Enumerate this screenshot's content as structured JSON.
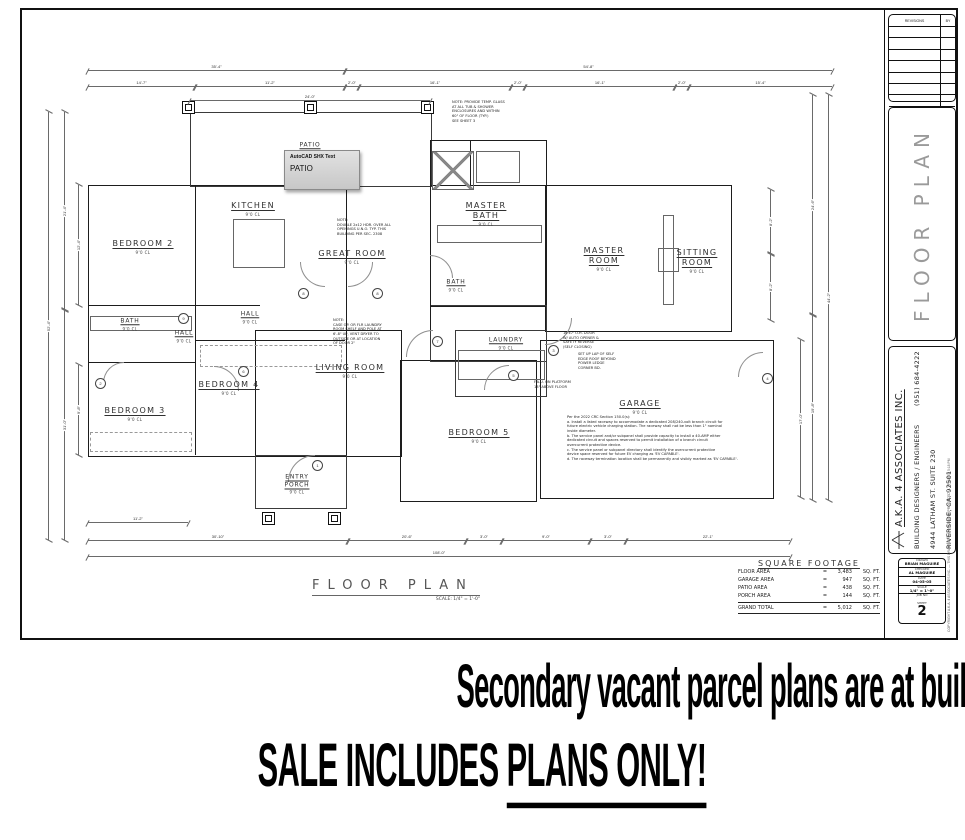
{
  "banner": {
    "line1": "Secondary vacant parcel plans are at building department for approval.",
    "line2_pre": "SALE INCLUDES ",
    "line2_underlined": "PLANS ONLY!"
  },
  "tooltip": {
    "title": "AutoCAD SHX Text",
    "text": "PATIO"
  },
  "plan_title": {
    "label": "FLOOR PLAN",
    "scale": "SCALE: 1/4\" = 1'-0\""
  },
  "rooms": [
    {
      "name": "BEDROOM 2",
      "sub": "9'0 CL",
      "x": 143,
      "y": 247
    },
    {
      "name": "KITCHEN",
      "sub": "9'0 CL",
      "x": 253,
      "y": 209
    },
    {
      "name": "GREAT ROOM",
      "sub": "9'0 CL",
      "x": 352,
      "y": 257
    },
    {
      "name": "MASTER\nBATH",
      "sub": "9'0 CL",
      "x": 486,
      "y": 214
    },
    {
      "name": "MASTER\nROOM",
      "sub": "9'0 CL",
      "x": 604,
      "y": 259
    },
    {
      "name": "SITTING\nROOM",
      "sub": "9'0 CL",
      "x": 697,
      "y": 261
    },
    {
      "name": "BATH",
      "sub": "9'0 CL",
      "x": 130,
      "y": 324,
      "small": true
    },
    {
      "name": "HALL",
      "sub": "9'0 CL",
      "x": 250,
      "y": 317,
      "small": true
    },
    {
      "name": "HALL",
      "sub": "9'0 CL",
      "x": 184,
      "y": 336,
      "small": true
    },
    {
      "name": "BEDROOM 3",
      "sub": "9'0 CL",
      "x": 135,
      "y": 414
    },
    {
      "name": "BEDROOM 4",
      "sub": "9'0 CL",
      "x": 229,
      "y": 388
    },
    {
      "name": "LIVING ROOM",
      "sub": "9'0 CL",
      "x": 350,
      "y": 371
    },
    {
      "name": "LAUNDRY",
      "sub": "9'0 CL",
      "x": 506,
      "y": 343,
      "small": true
    },
    {
      "name": "BEDROOM 5",
      "sub": "9'0 CL",
      "x": 479,
      "y": 436
    },
    {
      "name": "GARAGE",
      "sub": "9'0 CL",
      "x": 640,
      "y": 407
    },
    {
      "name": "ENTRY\nPORCH",
      "sub": "9'0 CL",
      "x": 297,
      "y": 484,
      "small": true
    },
    {
      "name": "PATIO",
      "sub": "",
      "x": 310,
      "y": 145,
      "small": true
    },
    {
      "name": "BATH",
      "sub": "9'0 CL",
      "x": 456,
      "y": 285,
      "small": true
    }
  ],
  "sqft": {
    "title": "SQUARE FOOTAGE",
    "rows": [
      [
        "FLOOR AREA",
        "=",
        "3,483",
        "SQ. FT."
      ],
      [
        "GARAGE AREA",
        "=",
        "947",
        "SQ. FT."
      ],
      [
        "PATIO AREA",
        "=",
        "438",
        "SQ. FT."
      ],
      [
        "PORCH AREA",
        "=",
        "144",
        "SQ. FT."
      ]
    ],
    "total": [
      "GRAND TOTAL",
      "=",
      "5,012",
      "SQ. FT."
    ]
  },
  "titleblock": {
    "revisions_header": "REVISIONS",
    "by_header": "BY",
    "panel_title": "FLOOR PLAN",
    "company": "A.K.A. 4 ASSOCIATES INC.",
    "line2": "BUILDING DESIGNERS / ENGINEERS",
    "line3": "4944 LATHAM ST. SUITE 230",
    "line4": "RIVERSIDE, CA.  92501",
    "phone": "(951) 684-4222",
    "info_rows": [
      [
        "DRAWN",
        "BRIAN MAGUIRE"
      ],
      [
        "CHECKED",
        "AL MAGUIRE"
      ],
      [
        "DATE",
        "04-05-05"
      ],
      [
        "SCALE",
        "1/4\" = 1'-0\""
      ],
      [
        "JOB NO",
        ""
      ]
    ],
    "sheet_label": "SHEET",
    "sheet_number": "2",
    "copyright": "COPYRIGHT A.K.A. 4 ASSOCIATES INC. — THIS DRAWING MAY NOT BE REPRODUCED — PRINTED 5:18 PM"
  },
  "drawing": {
    "walls": [
      [
        88,
        185,
        257,
        270,
        "thick"
      ],
      [
        190,
        112,
        240,
        73,
        "thin"
      ],
      [
        430,
        140,
        115,
        165,
        "thick"
      ],
      [
        545,
        185,
        185,
        145,
        "thick"
      ],
      [
        255,
        330,
        145,
        125,
        "thick"
      ],
      [
        400,
        360,
        135,
        140,
        "thick"
      ],
      [
        540,
        340,
        232,
        157,
        "thick"
      ],
      [
        255,
        455,
        90,
        52,
        "thin"
      ],
      [
        455,
        330,
        90,
        65,
        "thin"
      ],
      [
        430,
        305,
        115,
        55,
        "thin"
      ]
    ],
    "lines": [
      [
        195,
        185,
        120,
        "v"
      ],
      [
        88,
        305,
        172,
        "h"
      ],
      [
        88,
        362,
        107,
        "h"
      ],
      [
        195,
        305,
        150,
        "v"
      ],
      [
        195,
        340,
        150,
        "h"
      ],
      [
        430,
        185,
        115,
        "h"
      ],
      [
        470,
        140,
        45,
        "v"
      ],
      [
        430,
        305,
        25,
        "v"
      ]
    ],
    "fixtures": [
      [
        233,
        219,
        50,
        47,
        "box"
      ],
      [
        476,
        151,
        42,
        30,
        "box"
      ],
      [
        432,
        151,
        40,
        37,
        "xbox"
      ],
      [
        663,
        215,
        9,
        88,
        "box"
      ],
      [
        658,
        248,
        19,
        22,
        "box"
      ],
      [
        458,
        350,
        85,
        28,
        "box"
      ],
      [
        90,
        316,
        100,
        13,
        "box"
      ],
      [
        437,
        225,
        103,
        16,
        "box"
      ],
      [
        200,
        345,
        140,
        20,
        "dash"
      ],
      [
        90,
        432,
        100,
        18,
        "dash"
      ]
    ],
    "posts": [
      [
        182,
        101
      ],
      [
        304,
        101
      ],
      [
        421,
        101
      ],
      [
        262,
        512
      ],
      [
        328,
        512
      ]
    ],
    "arcs": [
      [
        300,
        262,
        24,
        "bl"
      ],
      [
        348,
        262,
        24,
        "br"
      ],
      [
        214,
        366,
        24,
        "tr"
      ],
      [
        288,
        455,
        26,
        "tl"
      ],
      [
        545,
        318,
        26,
        "br"
      ],
      [
        406,
        330,
        26,
        "tl"
      ],
      [
        484,
        365,
        24,
        "tl"
      ],
      [
        738,
        352,
        24,
        "tl"
      ],
      [
        430,
        255,
        22,
        "tr"
      ],
      [
        103,
        362,
        20,
        "tl"
      ]
    ],
    "tags": [
      [
        298,
        288,
        "8"
      ],
      [
        372,
        288,
        "8"
      ],
      [
        238,
        366,
        "6"
      ],
      [
        312,
        460,
        "1"
      ],
      [
        548,
        345,
        "3"
      ],
      [
        432,
        336,
        "7"
      ],
      [
        508,
        370,
        "5"
      ],
      [
        762,
        373,
        "4"
      ],
      [
        178,
        313,
        "9"
      ],
      [
        95,
        378,
        "2"
      ]
    ],
    "h_dims": [
      [
        88,
        70,
        257,
        "35'-4\""
      ],
      [
        345,
        70,
        487,
        "54'-8\""
      ],
      [
        88,
        86,
        107,
        "14'-7\""
      ],
      [
        195,
        86,
        150,
        "11'-2\""
      ],
      [
        345,
        86,
        14,
        "2'-0\""
      ],
      [
        359,
        86,
        152,
        "16'-1\""
      ],
      [
        511,
        86,
        14,
        "2'-0\""
      ],
      [
        525,
        86,
        150,
        "16'-1\""
      ],
      [
        675,
        86,
        14,
        "2'-0\""
      ],
      [
        689,
        86,
        143,
        "15'-4\""
      ],
      [
        190,
        100,
        240,
        "24'-0\""
      ],
      [
        88,
        522,
        100,
        "11'-2\""
      ],
      [
        88,
        540,
        260,
        "30'-10\""
      ],
      [
        348,
        540,
        118,
        "20'-6\""
      ],
      [
        466,
        540,
        36,
        "3'-0\""
      ],
      [
        502,
        540,
        88,
        "9'-0\""
      ],
      [
        590,
        540,
        36,
        "3'-0\""
      ],
      [
        626,
        540,
        164,
        "22'-1\""
      ],
      [
        88,
        556,
        702,
        "108'-0\""
      ]
    ],
    "v_dims": [
      [
        48,
        112,
        428,
        "52'-4\""
      ],
      [
        64,
        112,
        198,
        "21'-4\""
      ],
      [
        64,
        310,
        230,
        "31'-0\""
      ],
      [
        78,
        185,
        120,
        "12'-4\""
      ],
      [
        78,
        365,
        90,
        "9'-8\""
      ],
      [
        812,
        95,
        220,
        "24'-6\""
      ],
      [
        812,
        315,
        185,
        "19'-8\""
      ],
      [
        828,
        95,
        405,
        "44'-2\""
      ],
      [
        770,
        190,
        64,
        "8'-2\""
      ],
      [
        770,
        254,
        66,
        "8'-2\""
      ],
      [
        800,
        340,
        157,
        "17'-0\""
      ]
    ],
    "notes": [
      {
        "x": 337,
        "y": 218,
        "lines": [
          "NOTE:",
          "DOUBLE 2x12 HDR. OVER ALL",
          "OPENINGS U.N.O. TYP. THIS",
          "BUILDING PER SEC. 2308"
        ]
      },
      {
        "x": 333,
        "y": 318,
        "lines": [
          "NOTE:",
          "CASE OP. OR FLR LAUNDRY",
          "ROOM SHELF AND POLE AT",
          "6'-8\" UP, VENT DRYER TO",
          "OUTSIDE OR AT LOCATION",
          "OF DOOR 2\""
        ]
      },
      {
        "x": 563,
        "y": 331,
        "lines": [
          "16'x7' O.H. DOOR",
          "W/ AUTO OPENER &",
          "SAFETY REVERSE",
          "(SELF CLOSING)"
        ]
      },
      {
        "x": 578,
        "y": 352,
        "lines": [
          "SET UP LAP OF SELF",
          "EDGE ROOF BEYOND",
          "POWER LEDGE",
          "CORNER BD."
        ]
      },
      {
        "x": 534,
        "y": 380,
        "lines": [
          "F.A.U. ON PLATFORM",
          "18\" ABOVE FLOOR"
        ]
      },
      {
        "x": 452,
        "y": 100,
        "lines": [
          "NOTE: PROVIDE TEMP. GLASS",
          "AT ALL TUB & SHOWER",
          "ENCLOSURES AND WITHIN",
          "60\" OF FLOOR (TYP.)",
          "SEE SHEET 3"
        ]
      },
      {
        "x": 567,
        "y": 415,
        "lines": [
          "Per the 2022 CRC Section 150.0(s):",
          "a. Install a listed raceway to accommodate a dedicated 208/240-volt branch circuit for",
          "future electric vehicle charging station. The raceway shall not be less than 1\" nominal",
          "inside diameter.",
          "b. The service panel and/or subpanel shall provide capacity to install a 40-AMP either",
          "dedicated circuit and spaces reserved to permit installation of a branch circuit",
          "overcurrent protective device.",
          "c. The service panel or subpanel directory shall identify the overcurrent protective",
          "device space reserved for future EV charging as 'EV CAPABLE'.",
          "d. The raceway termination location shall be permanently and visibly marked as 'EV CAPABLE'."
        ]
      }
    ]
  }
}
